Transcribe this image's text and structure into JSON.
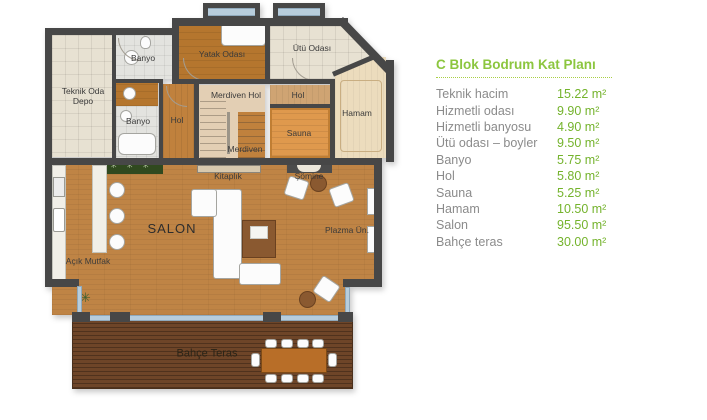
{
  "legend": {
    "title": "C Blok Bodrum Kat Planı",
    "items": [
      {
        "label": "Teknik hacim",
        "value": "15.22 m²"
      },
      {
        "label": "Hizmetli odası",
        "value": "9.90 m²"
      },
      {
        "label": "Hizmetli banyosu",
        "value": "4.90 m²"
      },
      {
        "label": "Ütü odası – boyler",
        "value": "9.50 m²"
      },
      {
        "label": "Banyo",
        "value": "5.75 m²"
      },
      {
        "label": "Hol",
        "value": "5.80 m²"
      },
      {
        "label": "Sauna",
        "value": "5.25 m²"
      },
      {
        "label": "Hamam",
        "value": "10.50 m²"
      },
      {
        "label": "Salon",
        "value": "95.50 m²"
      },
      {
        "label": "Bahçe teras",
        "value": "30.00 m²"
      }
    ]
  },
  "plan": {
    "labels": {
      "teknik_oda": "Teknik Oda\nDepo",
      "banyo_top": "Banyo",
      "banyo_bottom": "Banyo",
      "yatak_odasi": "Yatak Odası",
      "utu_odasi": "Ütü Odası",
      "hol_left": "Hol",
      "merdiven_hol": "Merdiven Hol",
      "hol_center": "Hol",
      "merdiven": "Merdiven",
      "sauna": "Sauna",
      "hamam": "Hamam",
      "kitaplik": "Kitaplık",
      "somine": "Şömine",
      "salon": "SALON",
      "acik_mutfak": "Açık Mutfak",
      "plazma": "Plazma Ün.",
      "bahce_teras": "Bahçe Teras"
    },
    "colors": {
      "wall": "#474747",
      "salon_wood": "#bf8445",
      "terrace_wood": "#6e4528",
      "sauna": "#df994d",
      "accent_green": "#8cc63f",
      "value_green": "#74b32c",
      "label_gray": "#8b8b8b",
      "window_glass": "#b7cddc"
    }
  }
}
